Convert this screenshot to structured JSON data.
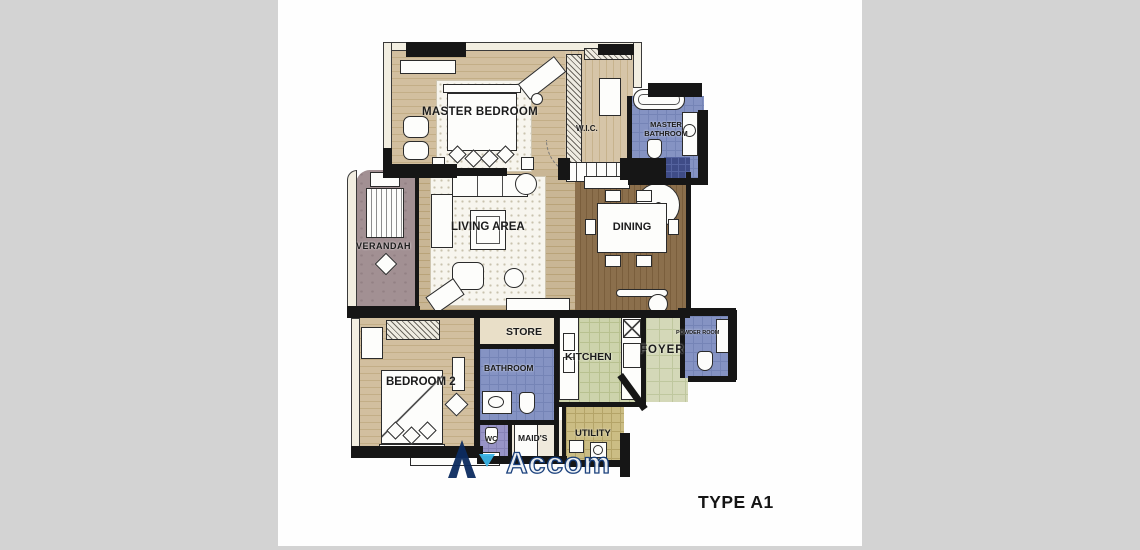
{
  "page": {
    "background_color": "#d3d3d3",
    "canvas_color": "#fefefe"
  },
  "plan": {
    "type_label": "TYPE A1",
    "rooms": {
      "master_bedroom": "MASTER BEDROOM",
      "wic": "W.I.C.",
      "master_bathroom": "MASTER BATHROOM",
      "verandah": "VERANDAH",
      "living_area": "LIVING AREA",
      "dining": "DINING",
      "store": "STORE",
      "kitchen": "KITCHEN",
      "foyer": "FOYER",
      "powder_room": "POWDER ROOM",
      "bedroom_2": "BEDROOM 2",
      "bathroom": "BATHROOM",
      "wc": "WC",
      "maids": "MAID'S",
      "utility": "UTILITY"
    },
    "floor_colors": {
      "wood_light": "#d2bf9f",
      "wood_living": "#c9b695",
      "wood_dining": "#8b6f4c",
      "tile_blue": "#8593c3",
      "tile_green": "#cdd3ac",
      "tile_foyer": "#d4d8b8",
      "tile_khaki": "#cbbd84",
      "tile_wc": "#9894c6",
      "verandah": "#a29093",
      "wall": "#161616"
    }
  },
  "watermark": {
    "logo_letter": "A",
    "text": "Accom",
    "logo_color": "#0c2c60",
    "accent_color": "#3ab5e6"
  }
}
